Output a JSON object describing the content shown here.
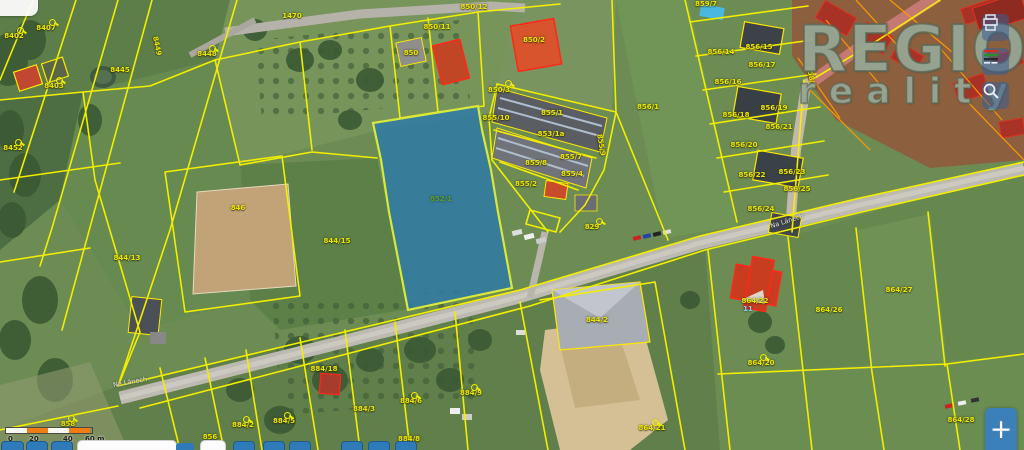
{
  "watermark": {
    "line1": "REGIO",
    "line2": "reality"
  },
  "controls": {
    "zoom_in_label": "+",
    "side_buttons": [
      {
        "icon": "print"
      },
      {
        "icon": "map-legend"
      },
      {
        "icon": "search"
      }
    ]
  },
  "scalebar": {
    "unit": "m",
    "ticks": [
      {
        "t": "0",
        "x": 3
      },
      {
        "t": "20",
        "x": 24
      },
      {
        "t": "40",
        "x": 58
      },
      {
        "t": "60 m",
        "x": 80
      }
    ]
  },
  "map": {
    "selected_parcel": {
      "number": "852/1",
      "highlight_color": "#2e7aa6"
    },
    "line_color": "#f2ee00",
    "labels": [
      {
        "t": "8402",
        "x": 14,
        "y": 36
      },
      {
        "t": "8407",
        "x": 46,
        "y": 28
      },
      {
        "t": "8449",
        "x": 157,
        "y": 46,
        "r": 78
      },
      {
        "t": "8448",
        "x": 207,
        "y": 54
      },
      {
        "t": "8445",
        "x": 120,
        "y": 70
      },
      {
        "t": "8403",
        "x": 54,
        "y": 86
      },
      {
        "t": "8452",
        "x": 13,
        "y": 148
      },
      {
        "t": "844/13",
        "x": 127,
        "y": 258
      },
      {
        "t": "846",
        "x": 238,
        "y": 208
      },
      {
        "t": "844/15",
        "x": 337,
        "y": 241
      },
      {
        "t": "852/1",
        "x": 441,
        "y": 199,
        "c": "green"
      },
      {
        "t": "855/10",
        "x": 496,
        "y": 118
      },
      {
        "t": "855/1",
        "x": 552,
        "y": 113
      },
      {
        "t": "853/1a",
        "x": 551,
        "y": 134
      },
      {
        "t": "855/8",
        "x": 536,
        "y": 163
      },
      {
        "t": "855/7",
        "x": 571,
        "y": 157
      },
      {
        "t": "855/4",
        "x": 572,
        "y": 174
      },
      {
        "t": "855/2",
        "x": 526,
        "y": 184
      },
      {
        "t": "855/9",
        "x": 601,
        "y": 145,
        "r": 80
      },
      {
        "t": "829",
        "x": 592,
        "y": 227
      },
      {
        "t": "856/1",
        "x": 648,
        "y": 107
      },
      {
        "t": "1470",
        "x": 292,
        "y": 16
      },
      {
        "t": "850/12",
        "x": 474,
        "y": 7
      },
      {
        "t": "850/11",
        "x": 437,
        "y": 27
      },
      {
        "t": "850",
        "x": 411,
        "y": 53
      },
      {
        "t": "850/2",
        "x": 534,
        "y": 40
      },
      {
        "t": "850/3",
        "x": 499,
        "y": 90
      },
      {
        "t": "859/7",
        "x": 706,
        "y": 4
      },
      {
        "t": "856/14",
        "x": 721,
        "y": 52
      },
      {
        "t": "856/15",
        "x": 759,
        "y": 47
      },
      {
        "t": "856/17",
        "x": 762,
        "y": 65
      },
      {
        "t": "856/16",
        "x": 728,
        "y": 82
      },
      {
        "t": "856/18",
        "x": 736,
        "y": 115
      },
      {
        "t": "856/19",
        "x": 774,
        "y": 108
      },
      {
        "t": "856/21",
        "x": 779,
        "y": 127
      },
      {
        "t": "856/20",
        "x": 744,
        "y": 145
      },
      {
        "t": "856/22",
        "x": 752,
        "y": 175
      },
      {
        "t": "856/23",
        "x": 792,
        "y": 172
      },
      {
        "t": "856/25",
        "x": 797,
        "y": 189
      },
      {
        "t": "856/24",
        "x": 761,
        "y": 209
      },
      {
        "t": "858/2",
        "x": 811,
        "y": 77,
        "r": 78
      },
      {
        "t": "864/22",
        "x": 755,
        "y": 301
      },
      {
        "t": "11",
        "x": 748,
        "y": 309,
        "c": "blue"
      },
      {
        "t": "864/20",
        "x": 761,
        "y": 363
      },
      {
        "t": "864/26",
        "x": 829,
        "y": 310
      },
      {
        "t": "864/27",
        "x": 899,
        "y": 290
      },
      {
        "t": "864/28",
        "x": 961,
        "y": 420
      },
      {
        "t": "864/21",
        "x": 652,
        "y": 428
      },
      {
        "t": "884/18",
        "x": 324,
        "y": 369
      },
      {
        "t": "884/2",
        "x": 243,
        "y": 425
      },
      {
        "t": "858",
        "x": 68,
        "y": 424
      },
      {
        "t": "856",
        "x": 210,
        "y": 437
      },
      {
        "t": "884/5",
        "x": 284,
        "y": 421
      },
      {
        "t": "884/3",
        "x": 364,
        "y": 409
      },
      {
        "t": "884/6",
        "x": 411,
        "y": 401
      },
      {
        "t": "884/9",
        "x": 471,
        "y": 393
      },
      {
        "t": "884/8",
        "x": 409,
        "y": 439
      },
      {
        "t": "844/2",
        "x": 597,
        "y": 320
      },
      {
        "t": "Na Lánech",
        "x": 130,
        "y": 382,
        "c": "street",
        "r": -10
      },
      {
        "t": "Na Lánech",
        "x": 787,
        "y": 221,
        "c": "street",
        "r": -18
      }
    ],
    "markers": [
      {
        "x": 17,
        "y": 27
      },
      {
        "x": 49,
        "y": 19
      },
      {
        "x": 209,
        "y": 45
      },
      {
        "x": 56,
        "y": 77
      },
      {
        "x": 15,
        "y": 139
      },
      {
        "x": 505,
        "y": 80
      },
      {
        "x": 596,
        "y": 218
      },
      {
        "x": 760,
        "y": 354
      },
      {
        "x": 68,
        "y": 415
      },
      {
        "x": 243,
        "y": 416
      },
      {
        "x": 284,
        "y": 412
      },
      {
        "x": 411,
        "y": 392
      },
      {
        "x": 471,
        "y": 384
      },
      {
        "x": 652,
        "y": 419
      }
    ]
  }
}
